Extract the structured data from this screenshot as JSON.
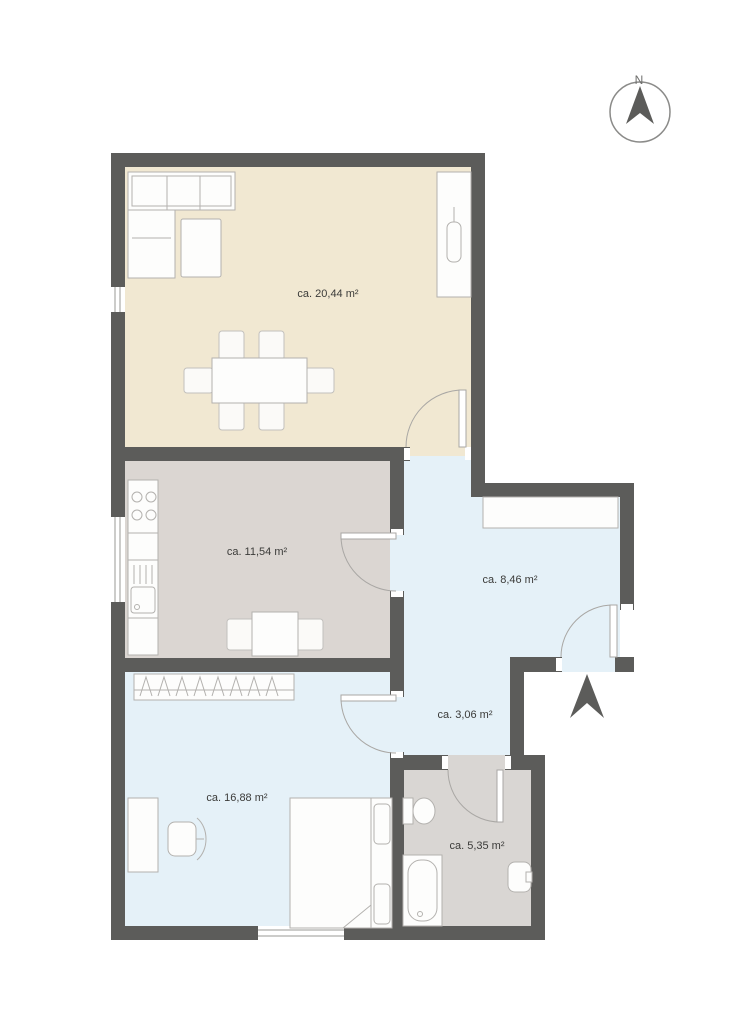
{
  "floor_plan": {
    "compass": {
      "north_label": "N"
    },
    "rooms": [
      {
        "name": "living-room",
        "area_label": "ca. 20,44 m²"
      },
      {
        "name": "kitchen",
        "area_label": "ca. 11,54 m²"
      },
      {
        "name": "hallway",
        "area_label": "ca. 8,46 m²"
      },
      {
        "name": "corridor",
        "area_label": "ca. 3,06 m²"
      },
      {
        "name": "bedroom",
        "area_label": "ca. 16,88 m²"
      },
      {
        "name": "bathroom",
        "area_label": "ca. 5,35 m²"
      }
    ],
    "colors": {
      "wall": "#5c5c5a",
      "living_room_floor": "#f1e8d2",
      "kitchen_floor": "#dbd6d2",
      "bathroom_floor": "#d9d6d3",
      "hallway_floor": "#e5f1f8",
      "bedroom_floor": "#e5f1f8",
      "label_text": "#3b3b39"
    },
    "icons": {
      "compass": "compass-north-icon",
      "entrance": "entrance-arrow-icon"
    }
  }
}
